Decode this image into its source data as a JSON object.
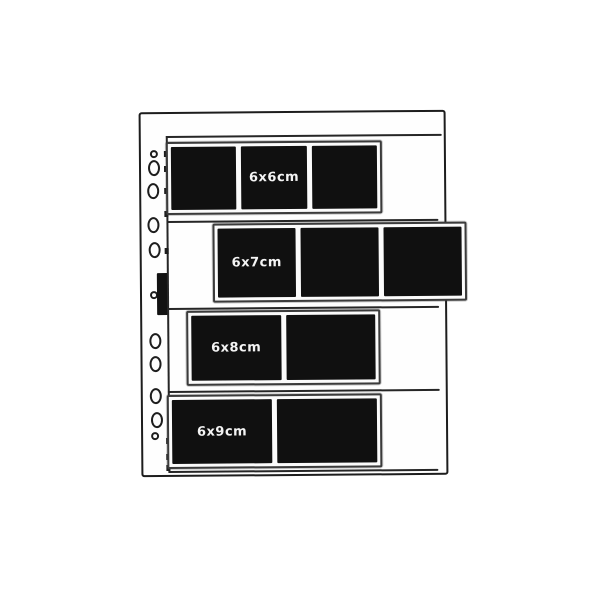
{
  "figure": {
    "description": "Line illustration of a punched ring-binder negative filing page holding four medium-format film strips",
    "paper_color": "#ffffff",
    "ink_color": "#1d1d1d",
    "film_color": "#101010",
    "rows": [
      {
        "label": "6x6cm",
        "frames": 3,
        "labeled_frame": 2
      },
      {
        "label": "6x7cm",
        "frames": 3,
        "labeled_frame": 1
      },
      {
        "label": "6x8cm",
        "frames": 2,
        "labeled_frame": 1
      },
      {
        "label": "6x9cm",
        "frames": 2,
        "labeled_frame": 1
      }
    ],
    "binder_hole_count": 11
  }
}
